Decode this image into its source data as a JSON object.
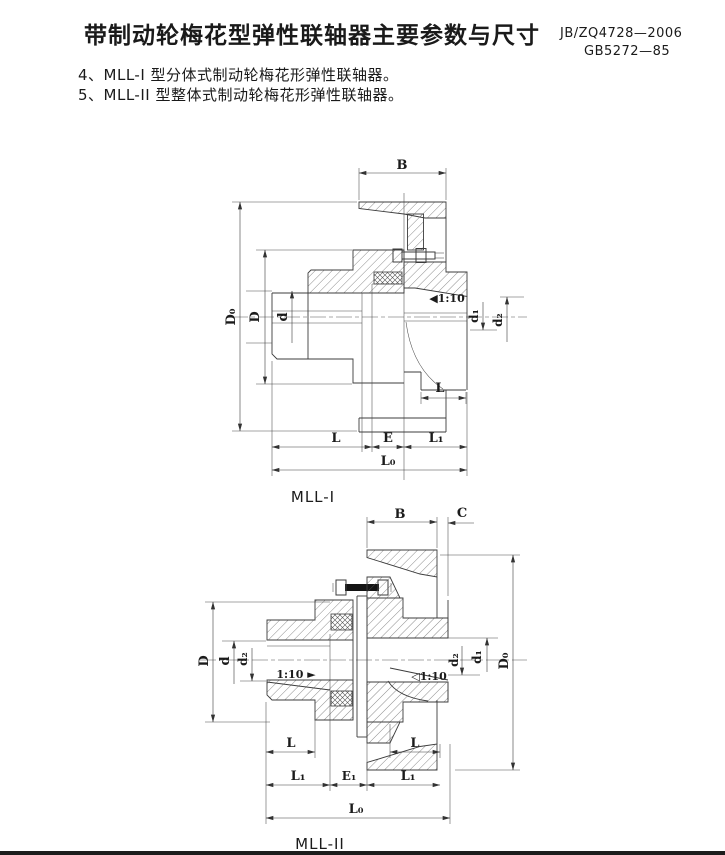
{
  "header": {
    "title": "带制动轮梅花型弹性联轴器主要参数与尺寸",
    "standard_1": "JB/ZQ4728—2006",
    "standard_2": "GB5272—85",
    "note_4": "4、MLL-I 型分体式制动轮梅花形弹性联轴器。",
    "note_5": "5、MLL-II 型整体式制动轮梅花形弹性联轴器。"
  },
  "f1": {
    "caption": "MLL-I",
    "B": "B",
    "Do": "D₀",
    "D": "D",
    "d": "d",
    "d1": "d₁",
    "d2": "d₂",
    "taper": "◀1:10",
    "Lr": "L",
    "L": "L",
    "E": "E",
    "L1": "L₁",
    "L0": "L₀"
  },
  "f2": {
    "caption": "MLL-II",
    "B": "B",
    "C": "C",
    "D": "D",
    "d": "d",
    "d2l": "d₂",
    "taperL": "1:10 ►",
    "taperR": "◁1:10",
    "d2r": "d₂",
    "d1": "d₁",
    "Do": "D₀",
    "Ll": "L",
    "Lr": "L",
    "L1l": "L₁",
    "E1": "E₁",
    "L1r": "L₁",
    "L0": "L₀"
  },
  "colors": {
    "line": "#3c3c3c",
    "ink": "#1a1a1a",
    "paper": "#ffffff"
  }
}
